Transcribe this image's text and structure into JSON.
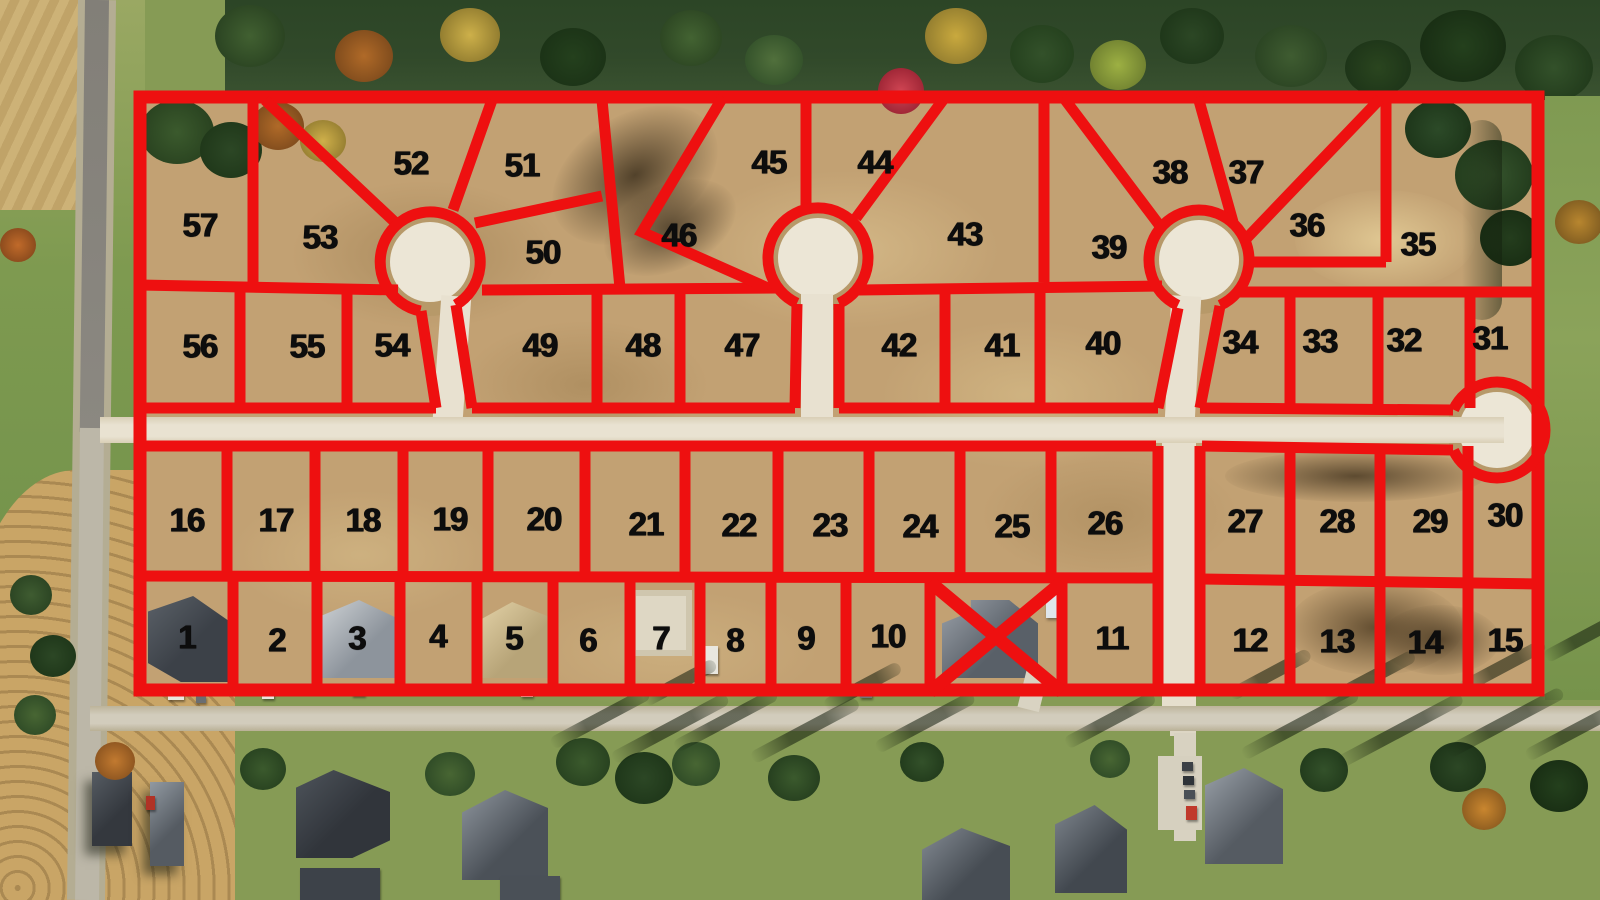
{
  "map": {
    "kind": "aerial-plat-overlay",
    "overlay_color": "#ee1010",
    "number_color": "#0d0d0d",
    "lots": [
      {
        "label": "1",
        "x": 187,
        "y": 637
      },
      {
        "label": "2",
        "x": 277,
        "y": 640
      },
      {
        "label": "3",
        "x": 357,
        "y": 638
      },
      {
        "label": "4",
        "x": 438,
        "y": 636
      },
      {
        "label": "5",
        "x": 514,
        "y": 638
      },
      {
        "label": "6",
        "x": 588,
        "y": 640
      },
      {
        "label": "7",
        "x": 661,
        "y": 638
      },
      {
        "label": "8",
        "x": 735,
        "y": 640
      },
      {
        "label": "9",
        "x": 806,
        "y": 638
      },
      {
        "label": "10",
        "x": 888,
        "y": 636
      },
      {
        "label": "11",
        "x": 1112,
        "y": 638
      },
      {
        "label": "12",
        "x": 1250,
        "y": 640
      },
      {
        "label": "13",
        "x": 1337,
        "y": 641
      },
      {
        "label": "14",
        "x": 1425,
        "y": 642
      },
      {
        "label": "15",
        "x": 1505,
        "y": 640
      },
      {
        "label": "16",
        "x": 187,
        "y": 520
      },
      {
        "label": "17",
        "x": 276,
        "y": 520
      },
      {
        "label": "18",
        "x": 363,
        "y": 520
      },
      {
        "label": "19",
        "x": 450,
        "y": 519
      },
      {
        "label": "20",
        "x": 544,
        "y": 519
      },
      {
        "label": "21",
        "x": 646,
        "y": 524
      },
      {
        "label": "22",
        "x": 739,
        "y": 525
      },
      {
        "label": "23",
        "x": 830,
        "y": 525
      },
      {
        "label": "24",
        "x": 920,
        "y": 526
      },
      {
        "label": "25",
        "x": 1012,
        "y": 526
      },
      {
        "label": "26",
        "x": 1105,
        "y": 523
      },
      {
        "label": "27",
        "x": 1245,
        "y": 521
      },
      {
        "label": "28",
        "x": 1337,
        "y": 521
      },
      {
        "label": "29",
        "x": 1430,
        "y": 521
      },
      {
        "label": "30",
        "x": 1505,
        "y": 515
      },
      {
        "label": "31",
        "x": 1490,
        "y": 338
      },
      {
        "label": "32",
        "x": 1404,
        "y": 340
      },
      {
        "label": "33",
        "x": 1320,
        "y": 341
      },
      {
        "label": "34",
        "x": 1240,
        "y": 342
      },
      {
        "label": "35",
        "x": 1418,
        "y": 244
      },
      {
        "label": "36",
        "x": 1307,
        "y": 225
      },
      {
        "label": "37",
        "x": 1246,
        "y": 172
      },
      {
        "label": "38",
        "x": 1170,
        "y": 172
      },
      {
        "label": "39",
        "x": 1109,
        "y": 247
      },
      {
        "label": "40",
        "x": 1103,
        "y": 343
      },
      {
        "label": "41",
        "x": 1002,
        "y": 345
      },
      {
        "label": "42",
        "x": 899,
        "y": 345
      },
      {
        "label": "43",
        "x": 965,
        "y": 234
      },
      {
        "label": "44",
        "x": 875,
        "y": 162
      },
      {
        "label": "45",
        "x": 769,
        "y": 162
      },
      {
        "label": "46",
        "x": 679,
        "y": 235
      },
      {
        "label": "47",
        "x": 742,
        "y": 345
      },
      {
        "label": "48",
        "x": 643,
        "y": 345
      },
      {
        "label": "49",
        "x": 540,
        "y": 345
      },
      {
        "label": "50",
        "x": 543,
        "y": 252
      },
      {
        "label": "51",
        "x": 522,
        "y": 165
      },
      {
        "label": "52",
        "x": 411,
        "y": 163
      },
      {
        "label": "53",
        "x": 320,
        "y": 237
      },
      {
        "label": "54",
        "x": 392,
        "y": 345
      },
      {
        "label": "55",
        "x": 307,
        "y": 346
      },
      {
        "label": "56",
        "x": 200,
        "y": 346
      },
      {
        "label": "57",
        "x": 200,
        "y": 225
      }
    ],
    "sold_lot_cross": {
      "x1": 930,
      "y1": 582,
      "x2": 1062,
      "y2": 692
    },
    "cul_de_sacs": [
      {
        "cx": 430,
        "cy": 262
      },
      {
        "cx": 818,
        "cy": 258
      },
      {
        "cx": 1199,
        "cy": 260
      },
      {
        "cx": 1497,
        "cy": 430
      }
    ]
  }
}
